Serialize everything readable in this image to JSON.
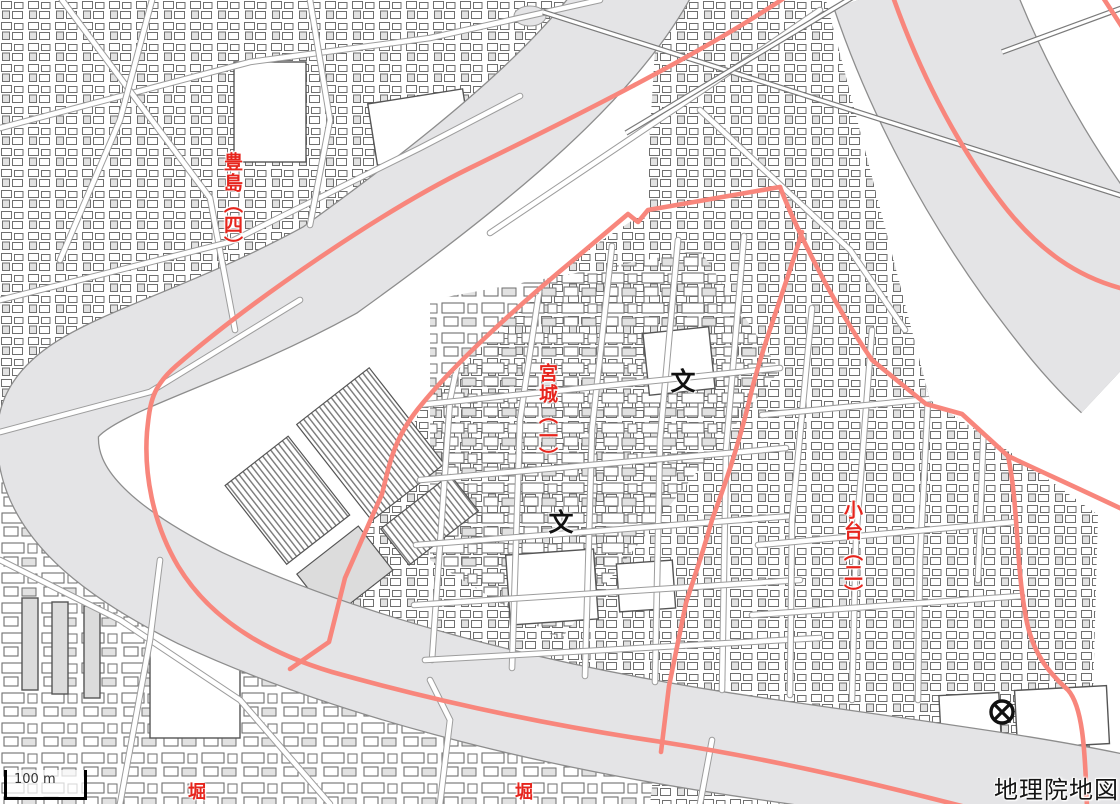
{
  "map": {
    "attribution": "地理院地図",
    "scale_bar": {
      "label": "100 m",
      "x": 4,
      "y": 770,
      "bar_width": 70,
      "bar_height": 24
    },
    "labels": [
      {
        "id": "toshima-4",
        "text": "豊島（四）",
        "x": 222,
        "y": 152,
        "font_size": 19
      },
      {
        "id": "miyagi-1",
        "text": "宮城（一）",
        "x": 537,
        "y": 363,
        "font_size": 19
      },
      {
        "id": "odai-2",
        "text": "小台（二）",
        "x": 842,
        "y": 500,
        "font_size": 19
      },
      {
        "id": "hori-1",
        "text": "堀",
        "x": 186,
        "y": 782,
        "font_size": 18
      },
      {
        "id": "hori-2",
        "text": "堀",
        "x": 513,
        "y": 782,
        "font_size": 18
      }
    ],
    "symbols": [
      {
        "type": "school",
        "glyph": "文",
        "x": 683,
        "y": 376,
        "size": 25
      },
      {
        "type": "school",
        "glyph": "文",
        "x": 561,
        "y": 517,
        "size": 25
      },
      {
        "type": "police-station",
        "x": 1002,
        "y": 712,
        "radius": 11
      }
    ],
    "colors": {
      "water": "#e4e4e6",
      "bank": "#8d8d8d",
      "road_red": "#f8867c",
      "label_red": "#e6251d",
      "casing": "#9d9d9d",
      "road_fill": "#ffffff",
      "building_line": "#6f6f6f",
      "building_fill": "#dcdcdc",
      "symbol_black": "#111111"
    },
    "geometry": {
      "rivers": [
        {
          "name": "sumida-river",
          "width": 100,
          "d": "M 648,-30 C 600,60 490,155 330,270 C 175,355 52,370 48,432 C 44,497 100,548 200,598 C 340,663 530,716 770,750 C 950,776 1060,790 1150,812"
        },
        {
          "name": "arakawa-river",
          "width": 176,
          "d": "M 918,-20 C 950,75 1000,168 1056,246 C 1090,292 1112,320 1142,348"
        }
      ],
      "red_roads": [
        {
          "name": "sumida-side-road",
          "d": "M 790,-6 C 706,52 560,124 470,168 C 382,211 252,300 176,366 C 152,387 150,402 147,432 C 144,472 152,522 178,566 C 207,614 258,650 332,672 C 432,700 540,724 662,742 C 790,762 900,790 985,812"
        },
        {
          "name": "northwest-boundary-road",
          "d": "M 780,187 L 648,210 L 638,222 L 628,214 L 577,257 C 520,304 458,360 422,404 C 394,437 390,462 382,494 L 345,578 L 329,642 L 290,669"
        },
        {
          "name": "arakawa-bank-road",
          "d": "M 780,187 C 796,228 832,302 872,360 L 926,404 L 962,414 L 1008,456"
        },
        {
          "name": "bank-road-branch-east",
          "d": "M 1008,456 C 1042,472 1082,490 1124,510"
        },
        {
          "name": "bank-road-branch-south",
          "d": "M 1008,456 C 1018,502 1016,562 1025,612 C 1031,652 1048,672 1068,690 C 1082,706 1085,744 1087,808"
        },
        {
          "name": "odai-bridge-road",
          "d": "M 802,232 C 784,292 760,352 749,402 C 734,462 719,500 712,520 C 699,566 691,586 686,603 L 669,686 L 661,752"
        },
        {
          "name": "arakawa-crossing-road",
          "d": "M 892,-6 C 918,68 954,140 998,198 C 1038,252 1080,278 1124,289"
        },
        {
          "name": "corner-road",
          "d": "M 1102,-4 L 1124,30"
        }
      ],
      "bridge_roads": [
        {
          "name": "long-bridge-road",
          "d": "M 543,12 L 1122,196"
        },
        {
          "name": "parallel-diagonal-road",
          "d": "M 626,133 L 858,-6"
        },
        {
          "name": "far-levee-road",
          "d": "M 1002,52 L 1122,8"
        }
      ],
      "local_roads": [
        {
          "d": "M 0,128 L 250,62 L 430,38 L 600,0",
          "clip": false
        },
        {
          "d": "M 62,0 L 210,198 L 235,330",
          "clip": false
        },
        {
          "d": "M 0,300 L 230,242 L 420,148 L 520,96",
          "clip": false
        },
        {
          "d": "M 490,233 L 700,92 L 820,10",
          "clip": false
        },
        {
          "d": "M 0,432 L 150,392 L 300,300",
          "clip": false
        },
        {
          "d": "M 152,0 L 120,120 L 60,260",
          "clip": false
        },
        {
          "d": "M 310,0 L 330,120 L 310,225",
          "clip": false
        },
        {
          "d": "M 0,560 L 120,620 L 240,700 L 330,804",
          "clip": false
        },
        {
          "d": "M 120,804 L 150,640 L 160,560",
          "clip": false
        },
        {
          "d": "M 440,804 L 450,720 L 430,680",
          "clip": false
        },
        {
          "d": "M 700,804 L 712,740",
          "clip": false
        },
        {
          "d": "M 480,258 L 450,400 L 432,660",
          "clip": true
        },
        {
          "d": "M 545,252 L 520,420 L 512,668",
          "clip": true
        },
        {
          "d": "M 612,246 L 592,430 L 585,676",
          "clip": true
        },
        {
          "d": "M 678,240 L 660,440 L 655,682",
          "clip": true
        },
        {
          "d": "M 744,236 L 726,450 L 722,690",
          "clip": true
        },
        {
          "d": "M 418,405 L 780,368",
          "clip": true
        },
        {
          "d": "M 420,480 L 786,448",
          "clip": true
        },
        {
          "d": "M 416,545 L 792,516",
          "clip": true
        },
        {
          "d": "M 414,605 L 800,580",
          "clip": true
        },
        {
          "d": "M 425,660 L 820,638",
          "clip": true
        },
        {
          "d": "M 812,308 L 792,520 L 790,695",
          "clip": true
        },
        {
          "d": "M 872,330 L 856,540 L 852,700",
          "clip": true
        },
        {
          "d": "M 930,358 L 920,560 L 918,700",
          "clip": true
        },
        {
          "d": "M 985,392 L 978,580",
          "clip": true
        },
        {
          "d": "M 762,415 L 1005,392",
          "clip": true
        },
        {
          "d": "M 758,545 L 1015,522",
          "clip": true
        },
        {
          "d": "M 752,615 L 1022,596",
          "clip": true
        },
        {
          "d": "M 700,110 L 850,250 L 905,330",
          "clip": true
        }
      ]
    }
  }
}
